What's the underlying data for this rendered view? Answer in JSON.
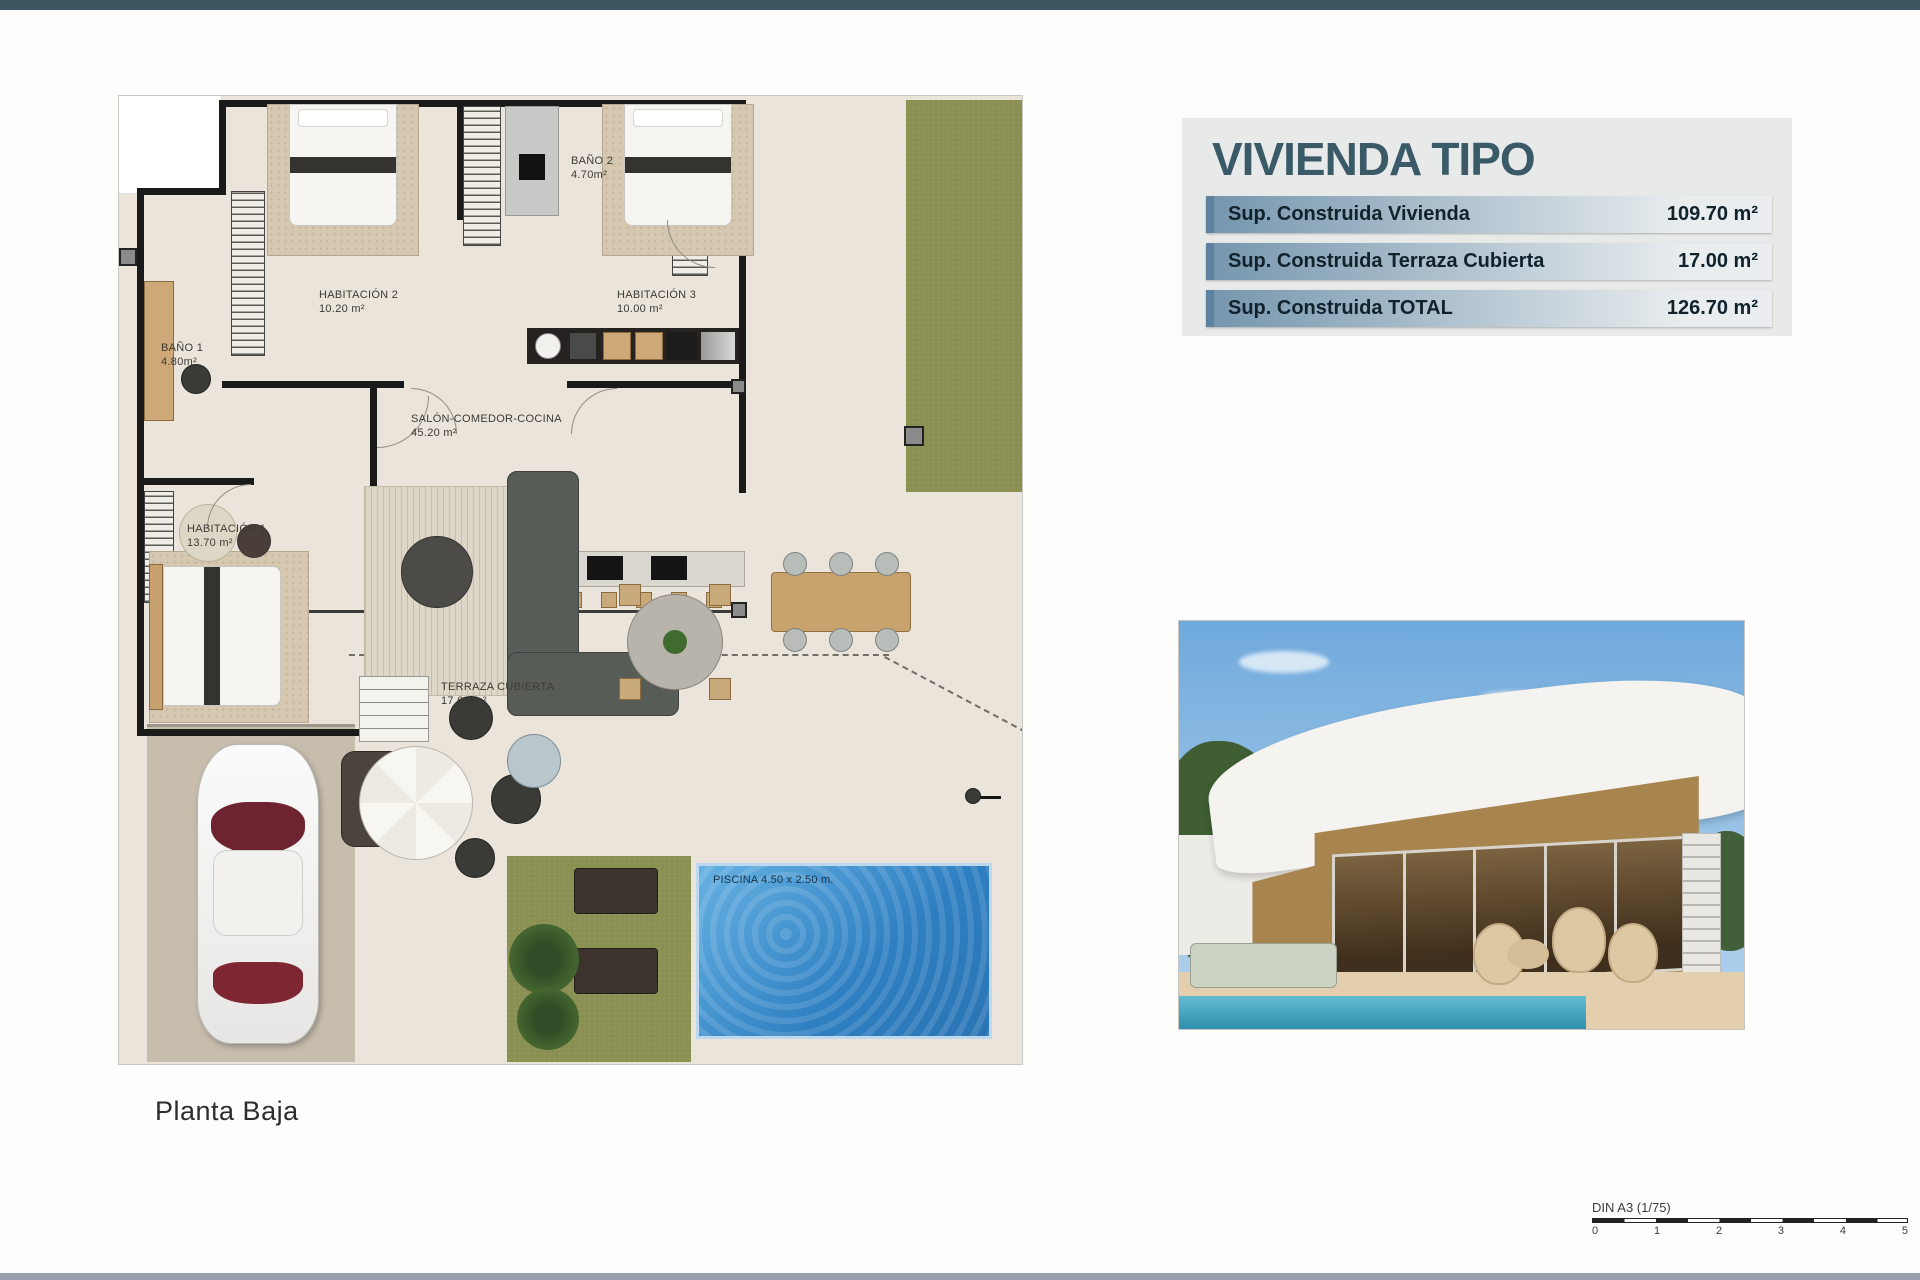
{
  "plan": {
    "caption": "Planta Baja",
    "rooms": [
      {
        "id": "habitacion-2",
        "label": "HABITACIÓN 2",
        "area": "10.20 m²"
      },
      {
        "id": "bano-2",
        "label": "BAÑO 2",
        "area": "4.70m²"
      },
      {
        "id": "habitacion-3",
        "label": "HABITACIÓN 3",
        "area": "10.00 m²"
      },
      {
        "id": "bano-1",
        "label": "BAÑO 1",
        "area": "4.80m²"
      },
      {
        "id": "salon",
        "label": "SALÓN-COMEDOR-COCINA",
        "area": "45.20 m²"
      },
      {
        "id": "habitacion-1",
        "label": "HABITACIÓN 1",
        "area": "13.70 m²"
      },
      {
        "id": "terraza",
        "label": "TERRAZA CUBIERTA",
        "area": "17.00 m²"
      }
    ],
    "pool_label": "PISCINA 4.50 x 2.50 m."
  },
  "summary": {
    "title": "VIVIENDA TIPO",
    "rows": [
      {
        "label": "Sup. Construida Vivienda",
        "value": "109.70 m²"
      },
      {
        "label": "Sup. Construida Terraza Cubierta",
        "value": "17.00 m²"
      },
      {
        "label": "Sup. Construida TOTAL",
        "value": "126.70 m²"
      }
    ]
  },
  "scalebar": {
    "label": "DIN A3 (1/75)",
    "ticks": [
      "0",
      "1",
      "2",
      "3",
      "4",
      "5"
    ]
  },
  "colors": {
    "top_bar": "#3d5662",
    "bottom_bar": "#9aa0ab",
    "title": "#3b5a68",
    "row_accent": "#5e82a0",
    "row_g1": "#7495ad",
    "row_g2": "#e9edef",
    "row_text": "#10222c",
    "panel_bg": "#e8eae9",
    "plan_floor": "#eae4da",
    "grass": "#8a8f52",
    "wall": "#1a1a1a"
  }
}
